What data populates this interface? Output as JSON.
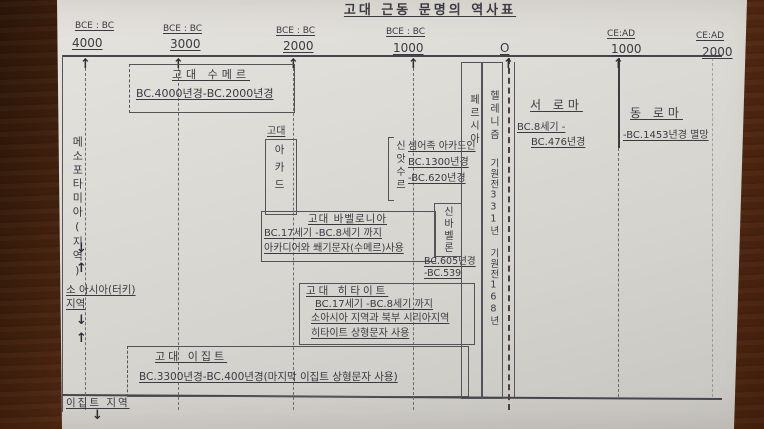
{
  "title": "고대 근동 문명의 역사표",
  "axis": {
    "ticks": [
      {
        "era": "BCE : BC",
        "year": "4000"
      },
      {
        "era": "BCE : BC",
        "year": "3000"
      },
      {
        "era": "BCE : BC",
        "year": "2000"
      },
      {
        "era": "BCE : BC",
        "year": "1000"
      },
      {
        "era": "",
        "year": "O"
      },
      {
        "era": "CE:AD",
        "year": "1000"
      },
      {
        "era": "CE:AD",
        "year": "2000"
      }
    ]
  },
  "left_labels": {
    "mesopotamia": "메소포타미아(지역)",
    "asia_minor_line1": "소 아시아(터키)",
    "asia_minor_line2": "지역",
    "egypt_region": "이집트 지역"
  },
  "sumer": {
    "title": "고대 수메르",
    "period": "BC.4000년경-BC.2000년경"
  },
  "akkad": {
    "prefix": "고대",
    "name": "아카드"
  },
  "assyria": {
    "name": "신앗수르",
    "desc": "셈어족 아카드인",
    "start": "BC.1300년경",
    "end": "-BC.620년경"
  },
  "babylonia": {
    "title": "고대 바벨로니아",
    "period": "BC.17세기 -BC.8세기 까지",
    "note": "아카디어와 쐐기문자(수메르)사용"
  },
  "neo_babylon": {
    "name": "신바벨론",
    "start": "BC.605년경",
    "end": "-BC.539"
  },
  "hittite": {
    "title": "고대 히타이트",
    "period": "BC.17세기 -BC.8세기 까지",
    "region": "소아시아 지역과 북부 시리아지역",
    "note": "히타이트 상형문자 사용"
  },
  "egypt": {
    "title": "고대 이집트",
    "period": "BC.3300년경-BC.400년경(마지막 이집트 상형문자 사용)"
  },
  "persia": {
    "name": "페르시아"
  },
  "hellenism": {
    "name": "헬레니즘",
    "start": "기원전331년",
    "end": "기원전168년"
  },
  "west_rome": {
    "title": "서 로마",
    "line1": "BC.8세기 -",
    "line2": "BC.476년경"
  },
  "east_rome": {
    "title": "동 로마",
    "line1": "-BC.1453년경 멸망"
  },
  "icons": {
    "up_arrow": "↑",
    "down_arrow": "↓"
  },
  "colors": {
    "paper": "#d8d6d1",
    "wood": "#6b3719",
    "ink": "#3a3a42"
  }
}
